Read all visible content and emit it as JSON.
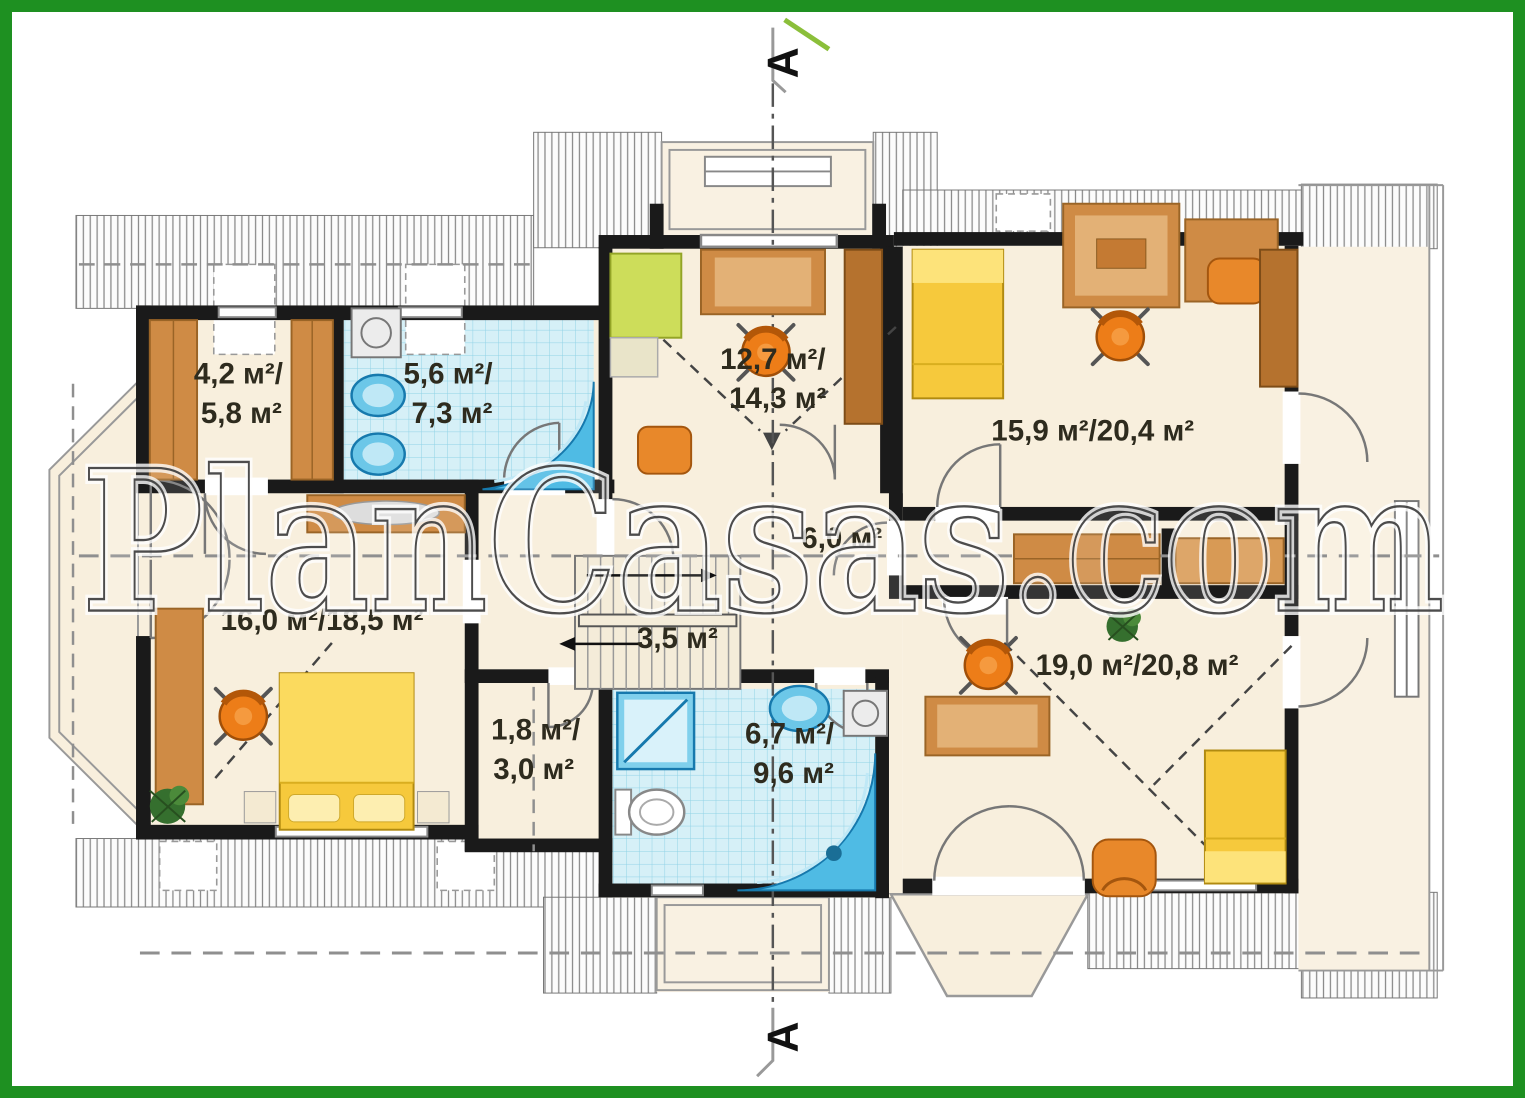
{
  "watermark": "PlanCasas.com",
  "section_markers": {
    "top": "A",
    "bottom": "A"
  },
  "colors": {
    "border_green": "#1e9021",
    "floor_cream": "#f8efdd",
    "tile_blue": "#d6f0f7",
    "fixture_blue": "#4fbbe4",
    "wood_brown": "#cf8b45",
    "bed_yellow": "#f6c93c",
    "chair_orange": "#ed7d18",
    "wall_black": "#1a1a1a"
  },
  "rooms": {
    "closet_top_left": {
      "line1": "4,2 м²/",
      "line2": "5,8 м²"
    },
    "bath_top": {
      "line1": "5,6 м²/",
      "line2": "7,3 м²"
    },
    "room_top_center": {
      "line1": "12,7 м²/",
      "line2": "14,3 м²"
    },
    "room_top_right": {
      "label": "15,9 м²/20,4 м²"
    },
    "hall": {
      "label": "6,0 м²"
    },
    "stairs": {
      "label": "3,5 м²"
    },
    "bedroom_left": {
      "label": "16,0 м²/18,5 м²"
    },
    "closet_small": {
      "line1": "1,8 м²/",
      "line2": "3,0 м²"
    },
    "bath_bottom": {
      "line1": "6,7 м²/",
      "line2": "9,6 м²"
    },
    "room_bottom_right": {
      "label": "19,0 м²/20,8 м²"
    }
  }
}
